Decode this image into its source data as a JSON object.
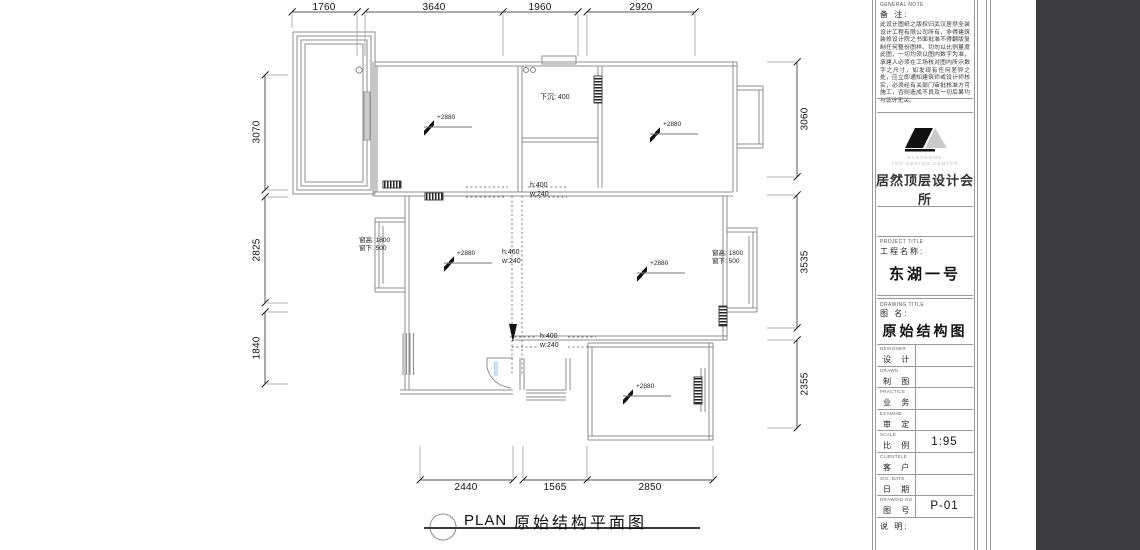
{
  "plan": {
    "title_en": "PLAN",
    "title_cn": "原始结构平面图",
    "dims": {
      "top": [
        "1760",
        "3640",
        "1960",
        "2920"
      ],
      "left": [
        "3070",
        "2825",
        "1840"
      ],
      "right": [
        "3060",
        "3535",
        "2355"
      ],
      "bottom": [
        "2440",
        "1565",
        "2850"
      ]
    },
    "annotations": {
      "sunken": "下沉: 400",
      "beam_top_h": "h:400",
      "beam_top_w": "w:240",
      "beam_mid_h": "h:460",
      "beam_mid_w": "w:240",
      "beam_bot_h": "h:400",
      "beam_bot_w": "w:240",
      "win_h": "窗高: 1800",
      "win_sill": "窗下: 500",
      "elevation": "+2880"
    }
  },
  "sheet": {
    "general_note": {
      "label_en": "GENERAL NOTE",
      "label_cn": "备 注:",
      "text": "此设计图纸之版权归武汉居然全装设计工程有限公司所有，非得建筑装修设计院之书面批准不得翻版复制任何整份图样。切勿以比例量度此图，一切均须以图内数字为准，承建人必须在工场核对图内所示数字之尺寸，如发现有任何差异之处，应立即通知建筑师或设计师核实，必须经有关部门审批核准方可施工，否则造成不良及一切后果均与设计无关。"
    },
    "logo": {
      "brand": "EASYHOME",
      "sub": "TOP DESIGN CENTER",
      "company": "居然顶层设计会所"
    },
    "project": {
      "label_en": "PROJECT TITLE",
      "label_cn": "工程名称:",
      "value": "东湖一号"
    },
    "drawing": {
      "label_en": "DRAWING TITLE",
      "label_cn": "图  名:",
      "value": "原始结构图"
    },
    "table_rows": [
      {
        "en": "DESIGNER",
        "cn": "设 计",
        "value": ""
      },
      {
        "en": "DRAWN",
        "cn": "制 图",
        "value": ""
      },
      {
        "en": "PRACTICE",
        "cn": "业 务",
        "value": ""
      },
      {
        "en": "EXAMINE",
        "cn": "审 定",
        "value": ""
      },
      {
        "en": "SCALE",
        "cn": "比 例",
        "value": "1:95"
      },
      {
        "en": "CLIENTELE",
        "cn": "客 户",
        "value": ""
      },
      {
        "en": "SIG. DATE",
        "cn": "日 期",
        "value": ""
      },
      {
        "en": "DRAWING NO.",
        "cn": "图 号",
        "value": "P-01"
      }
    ],
    "remark_label": "说 明:"
  }
}
